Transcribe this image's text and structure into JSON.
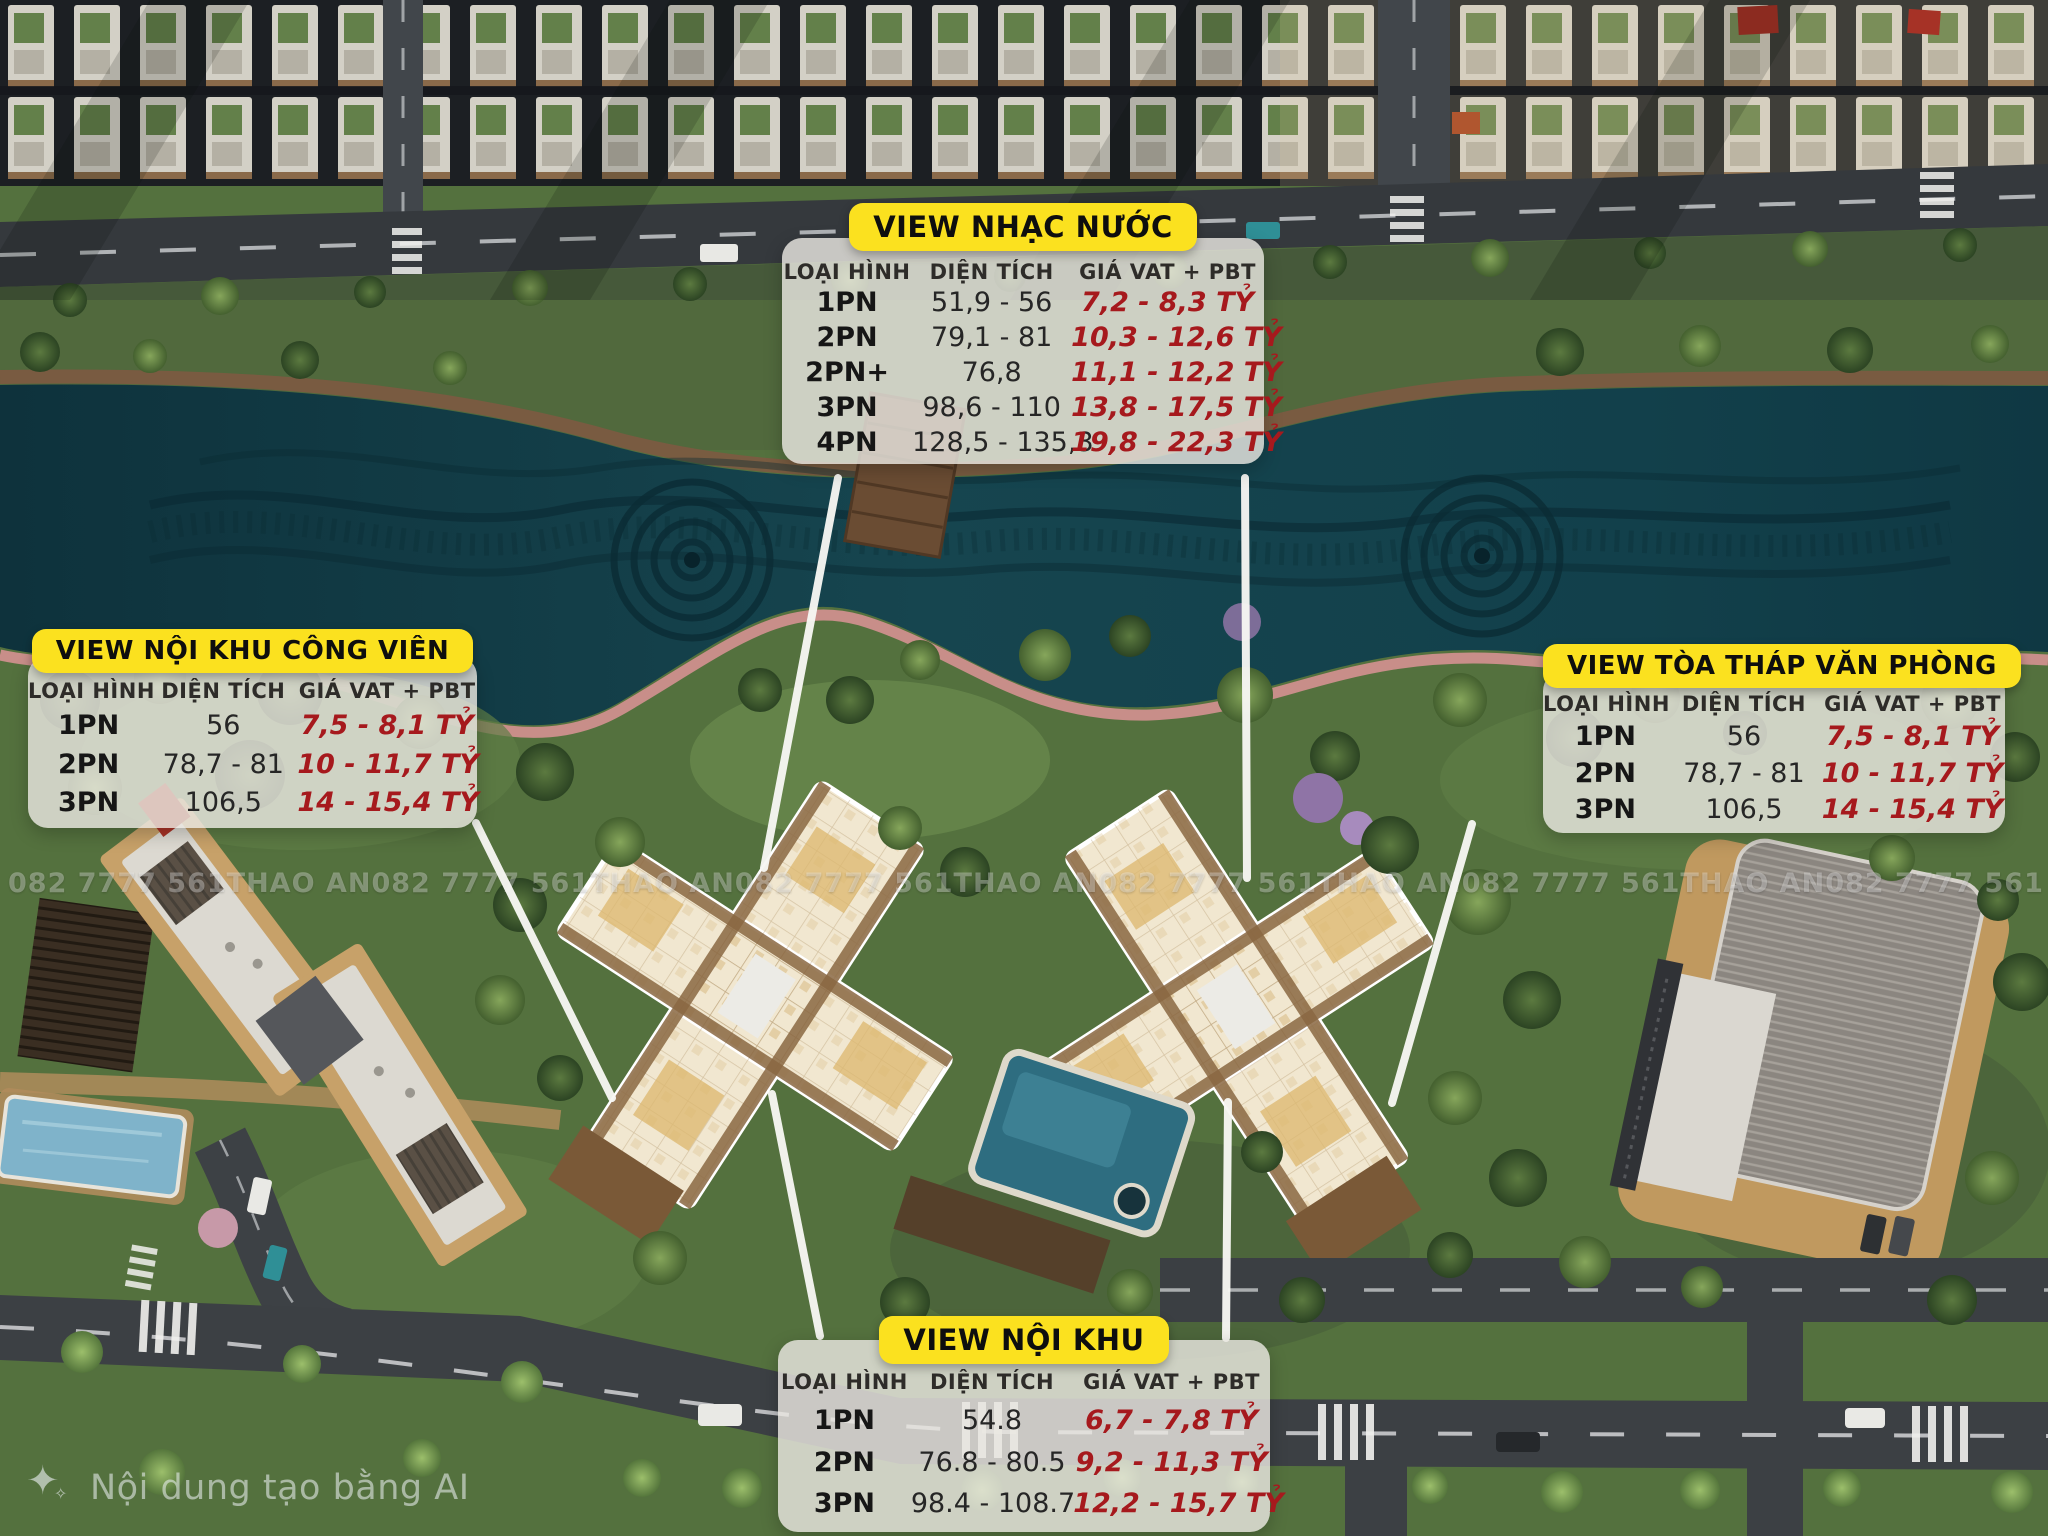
{
  "colors": {
    "badge_yellow": "#FBE11F",
    "price_red": "#A6191D",
    "panel_grey": "rgba(233,231,225,0.82)",
    "leader_line": "#F7F7F3",
    "lake_teal": "#15434E"
  },
  "watermark": {
    "phone": "082 7777 561",
    "brand": "THAO AN"
  },
  "ai_notice": {
    "icon": "sparkle-icon",
    "icon_glyph": "✦",
    "icon_glyph_small": "✧",
    "text": "Nội dung tạo bằng AI"
  },
  "tables": {
    "fountain": {
      "title": "VIEW NHẠC NƯỚC",
      "headers": {
        "type": "LOẠI HÌNH",
        "area": "DIỆN TÍCH",
        "price": "GIÁ VAT + PBT"
      },
      "rows": [
        {
          "type": "1PN",
          "area": "51,9 - 56",
          "price": "7,2 - 8,3 TỶ"
        },
        {
          "type": "2PN",
          "area": "79,1 - 81",
          "price": "10,3 - 12,6 TỶ"
        },
        {
          "type": "2PN+",
          "area": "76,8",
          "price": "11,1 - 12,2 TỶ"
        },
        {
          "type": "3PN",
          "area": "98,6 - 110",
          "price": "13,8 - 17,5 TỶ"
        },
        {
          "type": "4PN",
          "area": "128,5 - 135,3",
          "price": "19,8 - 22,3 TỶ"
        }
      ]
    },
    "park": {
      "title": "VIEW NỘI KHU CÔNG VIÊN",
      "headers": {
        "type": "LOẠI HÌNH",
        "area": "DIỆN TÍCH",
        "price": "GIÁ VAT + PBT"
      },
      "rows": [
        {
          "type": "1PN",
          "area": "56",
          "price": "7,5 - 8,1 TỶ"
        },
        {
          "type": "2PN",
          "area": "78,7 - 81",
          "price": "10 - 11,7 TỶ"
        },
        {
          "type": "3PN",
          "area": "106,5",
          "price": "14 - 15,4 TỶ"
        }
      ]
    },
    "office": {
      "title": "VIEW TÒA THÁP VĂN PHÒNG",
      "headers": {
        "type": "LOẠI HÌNH",
        "area": "DIỆN TÍCH",
        "price": "GIÁ VAT + PBT"
      },
      "rows": [
        {
          "type": "1PN",
          "area": "56",
          "price": "7,5 - 8,1 TỶ"
        },
        {
          "type": "2PN",
          "area": "78,7 - 81",
          "price": "10 - 11,7 TỶ"
        },
        {
          "type": "3PN",
          "area": "106,5",
          "price": "14 - 15,4 TỶ"
        }
      ]
    },
    "inner": {
      "title": "VIEW NỘI KHU",
      "headers": {
        "type": "LOẠI HÌNH",
        "area": "DIỆN TÍCH",
        "price": "GIÁ VAT + PBT"
      },
      "rows": [
        {
          "type": "1PN",
          "area": "54.8",
          "price": "6,7 - 7,8 TỶ"
        },
        {
          "type": "2PN",
          "area": "76.8 - 80.5",
          "price": "9,2 - 11,3 TỶ"
        },
        {
          "type": "3PN",
          "area": "98.4 - 108.7",
          "price": "12,2 - 15,7 TỶ"
        }
      ]
    }
  }
}
